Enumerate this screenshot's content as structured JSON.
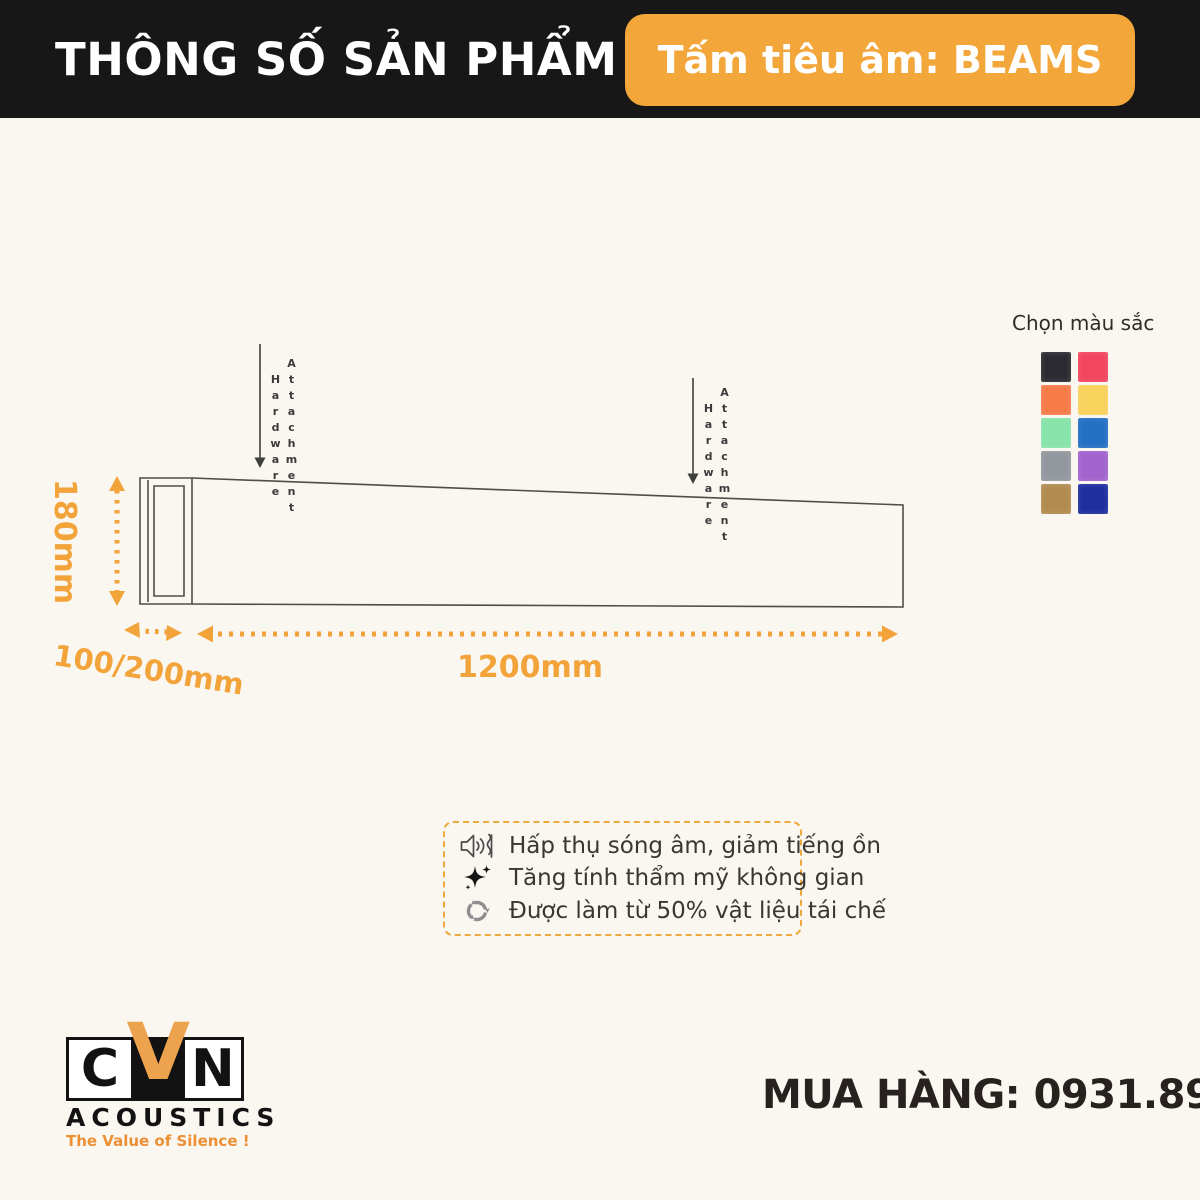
{
  "header": {
    "title": "THÔNG SỐ SẢN PHẨM",
    "badge_label": "Tấm tiêu âm: BEAMS"
  },
  "diagram": {
    "height_label": "180mm",
    "depth_label": "100/200mm",
    "length_label": "1200mm",
    "hardware_word_1": "Hardware",
    "hardware_word_2": "Attachment"
  },
  "color_picker": {
    "title": "Chọn màu sắc",
    "swatches": [
      {
        "name": "black",
        "hex": "#2b2b31"
      },
      {
        "name": "pink",
        "hex": "#f2455f"
      },
      {
        "name": "orange",
        "hex": "#f57b49"
      },
      {
        "name": "yellow",
        "hex": "#f8d25c"
      },
      {
        "name": "mint-green",
        "hex": "#87e3aa"
      },
      {
        "name": "blue",
        "hex": "#2470c4"
      },
      {
        "name": "gray",
        "hex": "#93989f"
      },
      {
        "name": "purple",
        "hex": "#a163cd"
      },
      {
        "name": "tan",
        "hex": "#b28b50"
      },
      {
        "name": "navy",
        "hex": "#1f2e9f"
      }
    ]
  },
  "features": {
    "items": [
      {
        "icon": "speaker-icon",
        "text": "Hấp thụ sóng âm, giảm tiếng ồn"
      },
      {
        "icon": "sparkle-icon",
        "text": "Tăng tính thẩm mỹ không gian"
      },
      {
        "icon": "recycle-icon",
        "text": "Được làm từ 50% vật liệu tái chế"
      }
    ]
  },
  "footer": {
    "logo": {
      "letter_c": "C",
      "letter_v": "V",
      "letter_n": "N",
      "name": "ACOUSTICS",
      "tagline": "The Value of Silence !"
    },
    "order_line": "MUA HÀNG: 0931.891.939"
  },
  "theme": {
    "accent_orange": "#f3a63a",
    "header_bg": "#171717",
    "page_bg": "#faf6f0",
    "line_color": "#514c49"
  }
}
